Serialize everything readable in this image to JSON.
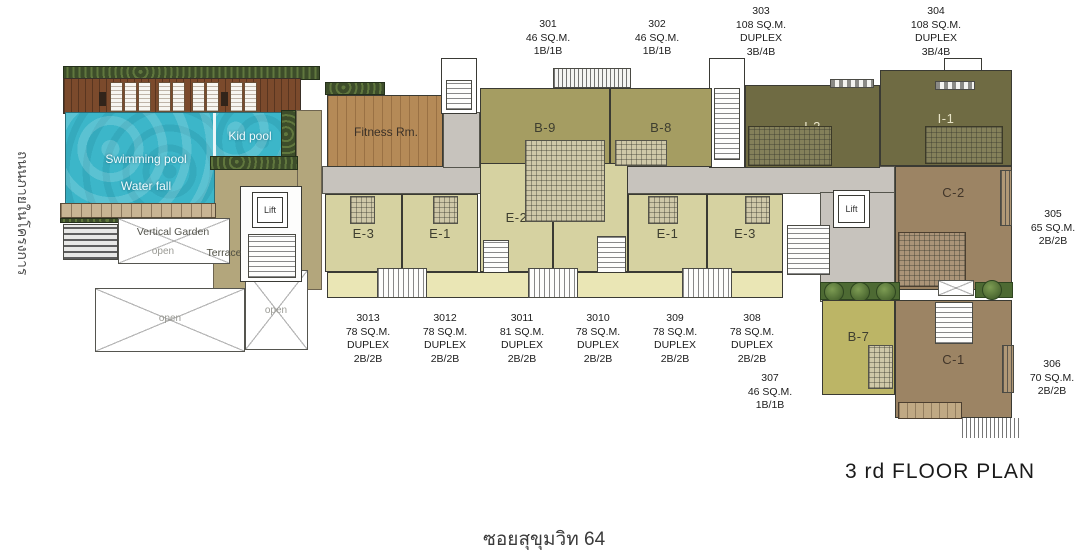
{
  "title": "3 rd  FLOOR PLAN",
  "bottom_road_label": "ซอยสุขุมวิท 64",
  "left_road_label": "ถนนภายในโครงการ",
  "amenities": {
    "fitness_room": "Fitness Rm.",
    "swimming_pool": "Swimming pool",
    "water_fall": "Water fall",
    "kid_pool": "Kid pool",
    "vertical_garden": "Vertical Garden",
    "terrace": "Terrace",
    "lift": "Lift",
    "open_area": "open"
  },
  "units": {
    "b9": "B-9",
    "b8": "B-8",
    "i2": "I-2",
    "i1": "I-1",
    "c2": "C-2",
    "c1": "C-1",
    "b7": "B-7",
    "e3_left": "E-3",
    "e1_left": "E-1",
    "e2_left": "E-2",
    "e2_right": "E-2",
    "e1_right": "E-1",
    "e3_right": "E-3"
  },
  "callouts": [
    {
      "lines": [
        "301",
        "46 SQ.M.",
        "1B/1B"
      ]
    },
    {
      "lines": [
        "302",
        "46 SQ.M.",
        "1B/1B"
      ]
    },
    {
      "lines": [
        "303",
        "108 SQ.M.",
        "DUPLEX",
        "3B/4B"
      ]
    },
    {
      "lines": [
        "304",
        "108 SQ.M.",
        "DUPLEX",
        "3B/4B"
      ]
    },
    {
      "lines": [
        "305",
        "65 SQ.M.",
        "2B/2B"
      ]
    },
    {
      "lines": [
        "306",
        "70 SQ.M.",
        "2B/2B"
      ]
    },
    {
      "lines": [
        "307",
        "46 SQ.M.",
        "1B/1B"
      ]
    },
    {
      "lines": [
        "308",
        "78 SQ.M.",
        "DUPLEX",
        "2B/2B"
      ]
    },
    {
      "lines": [
        "309",
        "78 SQ.M.",
        "DUPLEX",
        "2B/2B"
      ]
    },
    {
      "lines": [
        "3010",
        "78 SQ.M.",
        "DUPLEX",
        "2B/2B"
      ]
    },
    {
      "lines": [
        "3011",
        "81 SQ.M.",
        "DUPLEX",
        "2B/2B"
      ]
    },
    {
      "lines": [
        "3012",
        "78 SQ.M.",
        "DUPLEX",
        "2B/2B"
      ]
    },
    {
      "lines": [
        "3013",
        "78 SQ.M.",
        "DUPLEX",
        "2B/2B"
      ]
    }
  ],
  "colors": {
    "pool": "#3cb6c9",
    "wood_deck": "#7b4a2c",
    "fitness_wood": "#b58a57",
    "unit_olive": "#a59d62",
    "unit_pale": "#d6d2a1",
    "unit_dark_olive": "#6f6b43",
    "unit_brown": "#9c8464",
    "unit_b7": "#bcb566",
    "corridor_gray": "#c7c3bd",
    "ground_khaki": "#b3a67c",
    "balcony_pale": "#eae6b5",
    "hedge_green": "#3d4d2a",
    "bush_green": "#5d7c3c"
  }
}
